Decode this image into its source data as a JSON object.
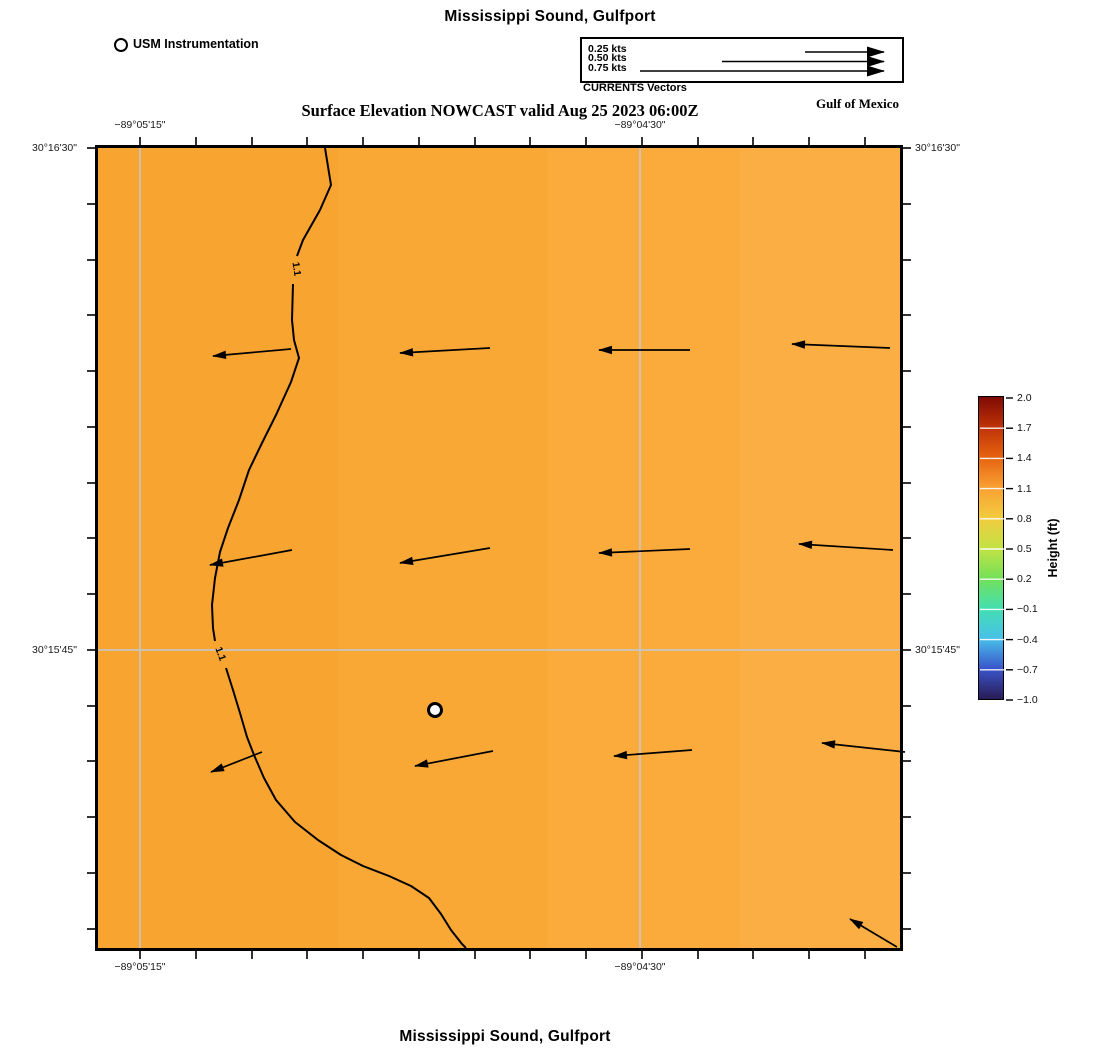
{
  "page": {
    "title_top": "Mississippi Sound, Gulfport",
    "title_bottom": "Mississippi Sound, Gulfport",
    "subtitle": "Surface Elevation NOWCAST valid Aug 25 2023 06:00Z",
    "region_label": "Gulf of Mexico"
  },
  "instrumentation_legend": {
    "label": "USM Instrumentation"
  },
  "vector_legend": {
    "caption": "CURRENTS Vectors",
    "head_x": 884,
    "entries": [
      {
        "label": "0.25 kts",
        "tail_x": 805,
        "y": 52
      },
      {
        "label": "0.50 kts",
        "tail_x": 722,
        "y": 61.5
      },
      {
        "label": "0.75 kts",
        "tail_x": 640,
        "y": 71
      }
    ]
  },
  "colorbar": {
    "label": "Height (ft)",
    "tick_labels": [
      "2.0",
      "1.7",
      "1.4",
      "1.1",
      "0.8",
      "0.5",
      "0.2",
      "−0.1",
      "−0.4",
      "−0.7",
      "−1.0"
    ],
    "gradient_top_to_bottom": [
      "#7f0a04",
      "#bf3307",
      "#e66311",
      "#f9a032",
      "#f2cb3e",
      "#c3e244",
      "#74e158",
      "#43dfb0",
      "#48c0ea",
      "#3a54cb",
      "#2a1c55"
    ],
    "geom": {
      "x": 980,
      "y": 398,
      "w": 24,
      "h": 302
    }
  },
  "axes": {
    "bounds": {
      "l": 98,
      "t": 148,
      "r": 900,
      "b": 948
    },
    "lon_labels": [
      {
        "text": "−89°05'15\"",
        "x": 140
      },
      {
        "text": "−89°04'30\"",
        "x": 640
      }
    ],
    "lat_labels": [
      {
        "text": "30°16'30\"",
        "y": 148
      },
      {
        "text": "30°15'45\"",
        "y": 650
      }
    ],
    "tick_xs": [
      140,
      196,
      252,
      307,
      363,
      419,
      475,
      530,
      586,
      642,
      698,
      753,
      809,
      865
    ],
    "tick_ys": [
      148,
      204,
      260,
      315,
      371,
      427,
      483,
      538,
      594,
      650,
      706,
      761,
      817,
      873,
      929
    ],
    "grid_xs": [
      140,
      640
    ],
    "grid_ys": [
      650
    ],
    "grid_color": "rgba(198,198,198,0.85)"
  },
  "map_render": {
    "fill_colors": [
      "#f8a431",
      "#f9a836",
      "#faab3c",
      "#fbae43"
    ],
    "coastline_segments": [
      "M325,148 L331,185 L320,210 L303,240 L297,256",
      "M293,284 L292,320 L294,340 L299,358 L291,382 L276,415 L262,443 L249,470 L239,500 L228,528 L220,552 L215,578 L212,605 L213,628 L215,641",
      "M226,668 L233,690 L240,713 L247,737 L254,755 L264,778 L276,800 L295,822 L318,840 L341,855 L363,866 L389,876 L411,886 L429,898 L441,914 L451,930 L462,944 L466,948"
    ],
    "contour_label": {
      "text": "1.1",
      "positions": [
        {
          "x": 296,
          "y": 269,
          "rot": 82
        },
        {
          "x": 220,
          "y": 654,
          "rot": 70
        }
      ]
    },
    "station": {
      "x": 435,
      "y": 710,
      "r": 6.5
    },
    "arrows": [
      [
        291,
        349,
        213,
        356
      ],
      [
        490,
        348,
        400,
        353
      ],
      [
        690,
        350,
        599,
        350
      ],
      [
        890,
        348,
        792,
        344
      ],
      [
        292,
        550,
        210,
        565
      ],
      [
        490,
        548,
        400,
        563
      ],
      [
        690,
        549,
        599,
        553
      ],
      [
        893,
        550,
        799,
        544
      ],
      [
        262,
        752,
        211,
        772
      ],
      [
        493,
        751,
        415,
        766
      ],
      [
        692,
        750,
        614,
        756
      ],
      [
        905,
        752,
        822,
        743
      ],
      [
        897,
        947,
        850,
        919
      ]
    ]
  },
  "chart_data": {
    "type": "map_vector_field",
    "title": "Mississippi Sound, Gulfport",
    "subtitle": "Surface Elevation NOWCAST valid Aug 25 2023 06:00Z",
    "field": "Surface elevation height (ft), shown as filled color",
    "field_value_shown": 1.1,
    "contour_level": 1.1,
    "colorbar_label": "Height (ft)",
    "colorbar_range": [
      -1.0,
      2.0
    ],
    "colorbar_tick_step": 0.3,
    "vector_legend_speeds_kts": [
      0.25,
      0.5,
      0.75
    ],
    "vectors": "grid of current vectors pointing westward (~0.25 kts), one northwest vector at SE corner",
    "station": "USM Instrumentation",
    "region": "Gulf of Mexico",
    "lon_ticks_labeled": [
      "−89°05'15\"",
      "−89°04'30\""
    ],
    "lat_ticks_labeled": [
      "30°16'30\"",
      "30°15'45\""
    ]
  }
}
